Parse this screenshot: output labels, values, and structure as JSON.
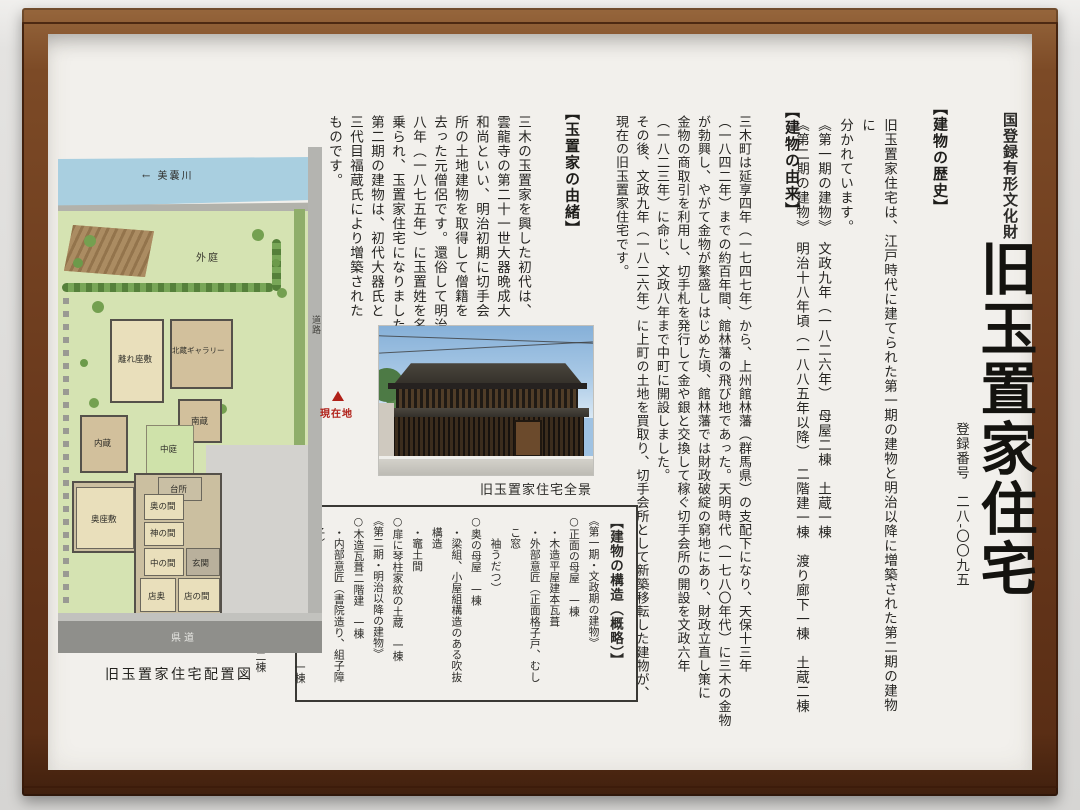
{
  "registration": {
    "category": "国登録有形文化財",
    "title": "旧玉置家住宅",
    "number": "登録番号　二八-〇〇九五"
  },
  "sections": {
    "history": {
      "heading": "【建物の歴史】",
      "lines": [
        "旧玉置家住宅は、江戸時代に建てられた第一期の建物と明治以降に増築された第二期の建物に",
        "分かれています。",
        "《第一期の建物》　文政九年（一八二六年）　母屋二棟　土蔵一棟",
        "《第二期の建物》　明治十八年頃（一八八五年以降）　二階建一棟　渡り廊下一棟　土蔵二棟"
      ],
      "furigana": [
        "ぶんせい（文政）",
        "おもや（母屋）",
        "どぞう（土蔵）"
      ]
    },
    "origin": {
      "heading": "【建物の由来】",
      "lines": [
        "三木町は延享四年（一七四七年）から、上州館林藩（群馬県）の支配下になり、天保十三年",
        "（一八四二年）までの約百年間、館林藩の飛び地であった。天明時代（一七八〇年代）に三木の金物",
        "が勃興し、やがて金物が繁盛しはじめた頃、館林藩では財政破綻の窮地にあり、財政立直し策に",
        "金物の商取引を利用し、切手札を発行して金や銀と交換して稼ぐ切手会所の開設を文政六年",
        "（一八二三年）に命じ、文政八年まで中町に開設しました。",
        "その後、文政九年（一八二六年）に上町の土地を買取り、切手会所として新築移転した建物が、",
        "現在の旧玉置家住宅です。"
      ],
      "furigana": [
        "えんきょう（延享）",
        "じょうしゅうたてばやしはん（上州館林藩）",
        "てんぽう（天保）",
        "ぼっこう（勃興）",
        "はんじょう（繁盛）",
        "てんめい（天明）",
        "ざいせいはたん（財政破綻）",
        "きゅうち（窮地）",
        "きってさつ（切手札）",
        "かせ（稼）",
        "きってかいしょ（切手会所）",
        "かんまち（上町）"
      ]
    },
    "lineage": {
      "heading": "【玉置家の由緒】",
      "lines": [
        "三木の玉置家を興した初代は、",
        "雲龍寺の第二十一世大器晩成大",
        "和尚といい、明治初期に切手会",
        "所の土地建物を取得して僧籍を",
        "去った元僧侶です。還俗して明治",
        "八年（一八七五年）に玉置姓を名",
        "乗られ、玉置家住宅になりました。",
        "第二期の建物は、初代大器氏と",
        "三代目福蔵氏により増築された",
        "ものです。"
      ],
      "furigana": [
        "おこ（興）",
        "うんりゅうじ（雲龍寺）",
        "だいきばんじょうだい（大器晩成大）",
        "おしょう（和尚）",
        "そうせき（僧籍）",
        "げんぞく（還俗）",
        "だいき（大器）",
        "ふくぞう（福蔵）"
      ]
    },
    "structure": {
      "lines": [
        "【建物の構造（概略）】",
        "《第一期・文政期の建物》",
        "○正面の母屋　一棟",
        "・木造平屋建本瓦葺",
        "・外部意匠（正面格子戸、むしこ窓",
        "　袖うだつ）",
        "○奥の母屋　一棟",
        "・梁組、小屋組構造のある吹抜構造",
        "・竈土間",
        "○扉に琴柱家紋の土蔵　一棟",
        "《第二期・明治以降の建物》",
        "○木造瓦葺二階建　一棟",
        "・内部意匠（書院造り、組子障子）",
        "○木造瓦葺平屋建渡り廊下　一棟",
        "・緩傾斜構造の廊下",
        "○土蔵造瓦葺二階建土蔵　二棟"
      ],
      "furigana": [
        "ほんがわらぶき（本瓦葺）",
        "いしょう（意匠）",
        "こうし（格子）",
        "そで（袖）",
        "はりぐみ（梁組）",
        "かまど（竈）",
        "ことじかもん（琴柱家紋）",
        "しょいん（書院）",
        "くみこしょうじ（組子障子）",
        "かんけいしゃ（緩傾斜）"
      ]
    }
  },
  "photo": {
    "caption": "旧玉置家住宅全景"
  },
  "map": {
    "caption": "旧玉置家住宅配置図",
    "labels": {
      "river": "← 美嚢川",
      "outer_garden": "外庭",
      "detached_room": "離れ座敷",
      "north_kura_gallery": "北蔵ギャラリー",
      "south_kura": "南蔵",
      "inner_kura": "内蔵",
      "courtyard": "中庭",
      "kitchen": "台所",
      "back_room": "奥の間",
      "kami_room": "神の間",
      "back_parlor": "奥座敷",
      "middle_room": "中の間",
      "entrance": "玄関",
      "store_back": "店奥",
      "store_room": "店の間",
      "road": "道路",
      "current_location": "現在地",
      "prefectural_road": "県道"
    }
  },
  "colors": {
    "frame_wood": "#6b3a1d",
    "panel": "#f2f0ec",
    "text": "#262522",
    "map_field_green": "#d5e3b2",
    "map_river_blue": "#a9cfe0",
    "map_building_tan": "#d2c09c",
    "map_tatami": "#e9dfbb",
    "current_location_red": "#b02018"
  }
}
